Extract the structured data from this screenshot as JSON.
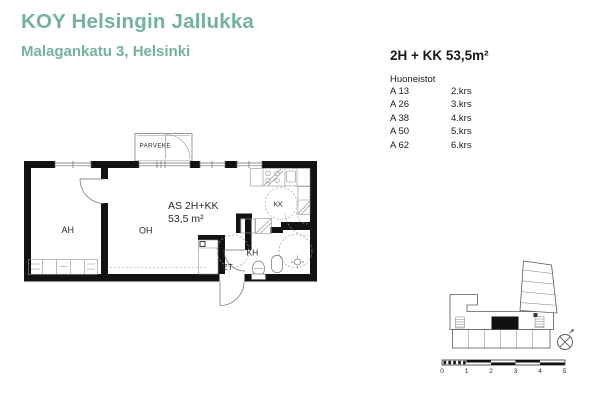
{
  "header": {
    "title": "KOY Helsingin Jallukka",
    "subtitle": "Malagankatu 3, Helsinki",
    "accent_color": "#74b29e"
  },
  "info_panel": {
    "apartment_type": "2H + KK 53,5m²",
    "list_heading": "Huoneistot",
    "apartments": [
      {
        "unit": "A 13",
        "floor": "2.krs"
      },
      {
        "unit": "A 26",
        "floor": "3.krs"
      },
      {
        "unit": "A 38",
        "floor": "4.krs"
      },
      {
        "unit": "A 50",
        "floor": "5.krs"
      },
      {
        "unit": "A 62",
        "floor": "6.krs"
      }
    ]
  },
  "floor_plan": {
    "apartment_label": "AS 2H+KK",
    "area_label": "53,5 m²",
    "rooms": {
      "balcony": "PARVEKE",
      "bedroom": "AH",
      "living_room": "OH",
      "kitchenette": "KK",
      "bathroom": "KH",
      "entry": "ET"
    }
  },
  "key_plan": {
    "scale_labels": [
      "0",
      "1",
      "2",
      "3",
      "4",
      "5"
    ]
  }
}
